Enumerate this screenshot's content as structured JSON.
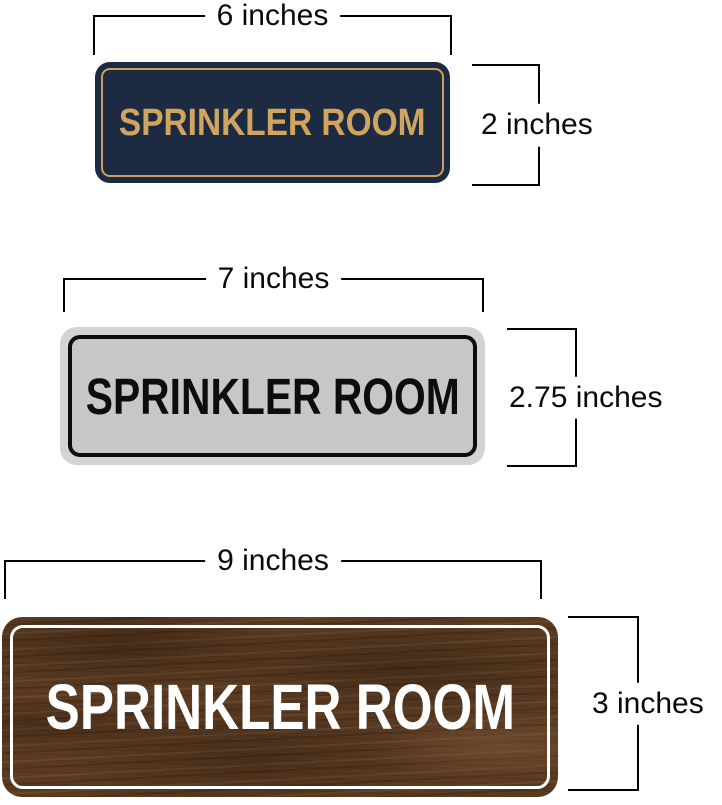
{
  "page": {
    "background_color": "#ffffff",
    "description": "Size comparison of three SPRINKLER ROOM wall signs with dimension brackets"
  },
  "signs": [
    {
      "id": "navy-gold",
      "label": "SPRINKLER ROOM",
      "width_label": "6 inches",
      "height_label": "2 inches",
      "colors": {
        "plate": "#1c2a42",
        "inner_border": "#c9a05c",
        "text": "#d2a55e"
      }
    },
    {
      "id": "silver-black",
      "label": "SPRINKLER ROOM",
      "width_label": "7 inches",
      "height_label": "2.75 inches",
      "colors": {
        "outer_frame": "#d3d3d3",
        "plate": "#c7c7c9",
        "inner_border": "#0d0d0d",
        "text": "#0d0d0d"
      }
    },
    {
      "id": "walnut-wood",
      "label": "SPRINKLER ROOM",
      "width_label": "9 inches",
      "height_label": "3 inches",
      "colors": {
        "plate": "#5a3b22",
        "wood_dark": "#3f2817",
        "wood_light": "#7b573a",
        "inner_border": "#ffffff",
        "text": "#ffffff"
      }
    }
  ],
  "dimension_style": {
    "line_color": "#000000",
    "text_color": "#0a0a0a"
  }
}
